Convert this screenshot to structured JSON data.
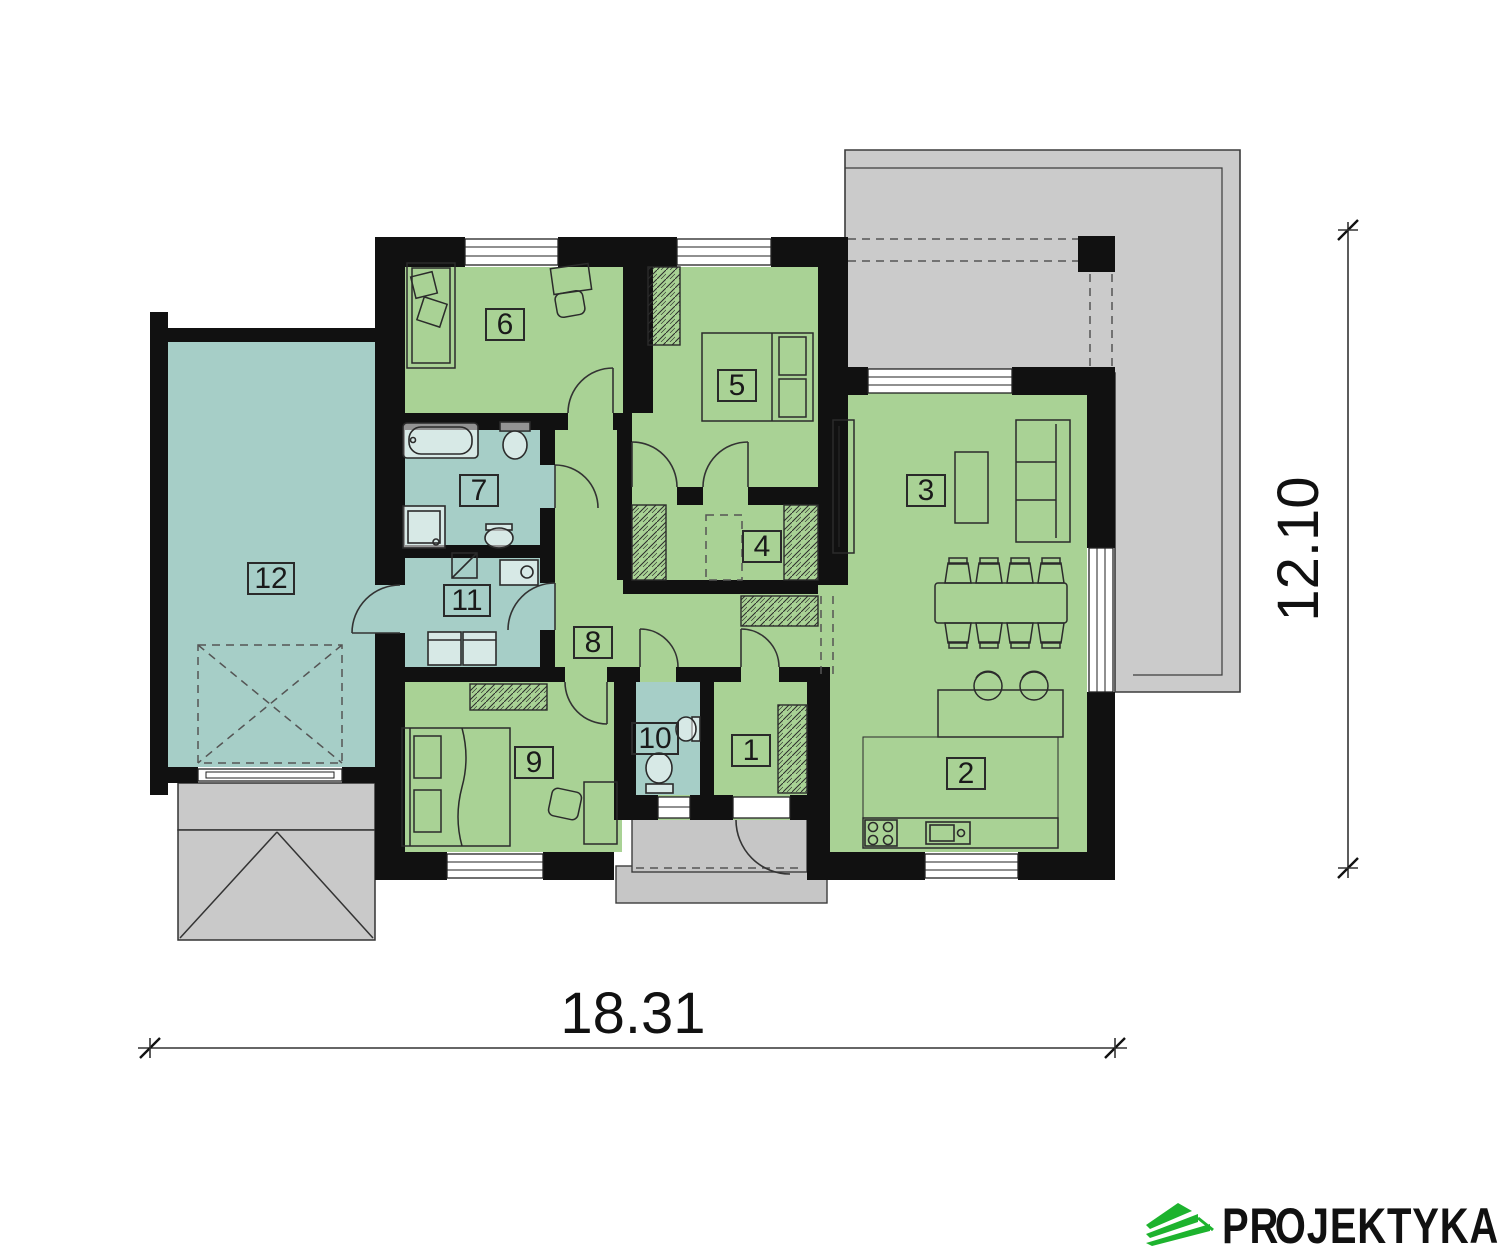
{
  "plan": {
    "rooms": [
      {
        "num": "1"
      },
      {
        "num": "2"
      },
      {
        "num": "3"
      },
      {
        "num": "4"
      },
      {
        "num": "5"
      },
      {
        "num": "6"
      },
      {
        "num": "7"
      },
      {
        "num": "8"
      },
      {
        "num": "9"
      },
      {
        "num": "10"
      },
      {
        "num": "11"
      },
      {
        "num": "12"
      }
    ],
    "dimensions": {
      "width": "18.31",
      "height": "12.10"
    },
    "colors": {
      "room_green": "#a9d295",
      "room_teal": "#a6cec7",
      "wall_black": "#111111",
      "terrace_gray": "#cbcbcb",
      "porch_gray": "#c6c6c6",
      "logo_green": "#1db32e"
    }
  },
  "branding": {
    "logo_pre": "PR",
    "logo_o": "O",
    "logo_post": "JEKTYKA"
  }
}
